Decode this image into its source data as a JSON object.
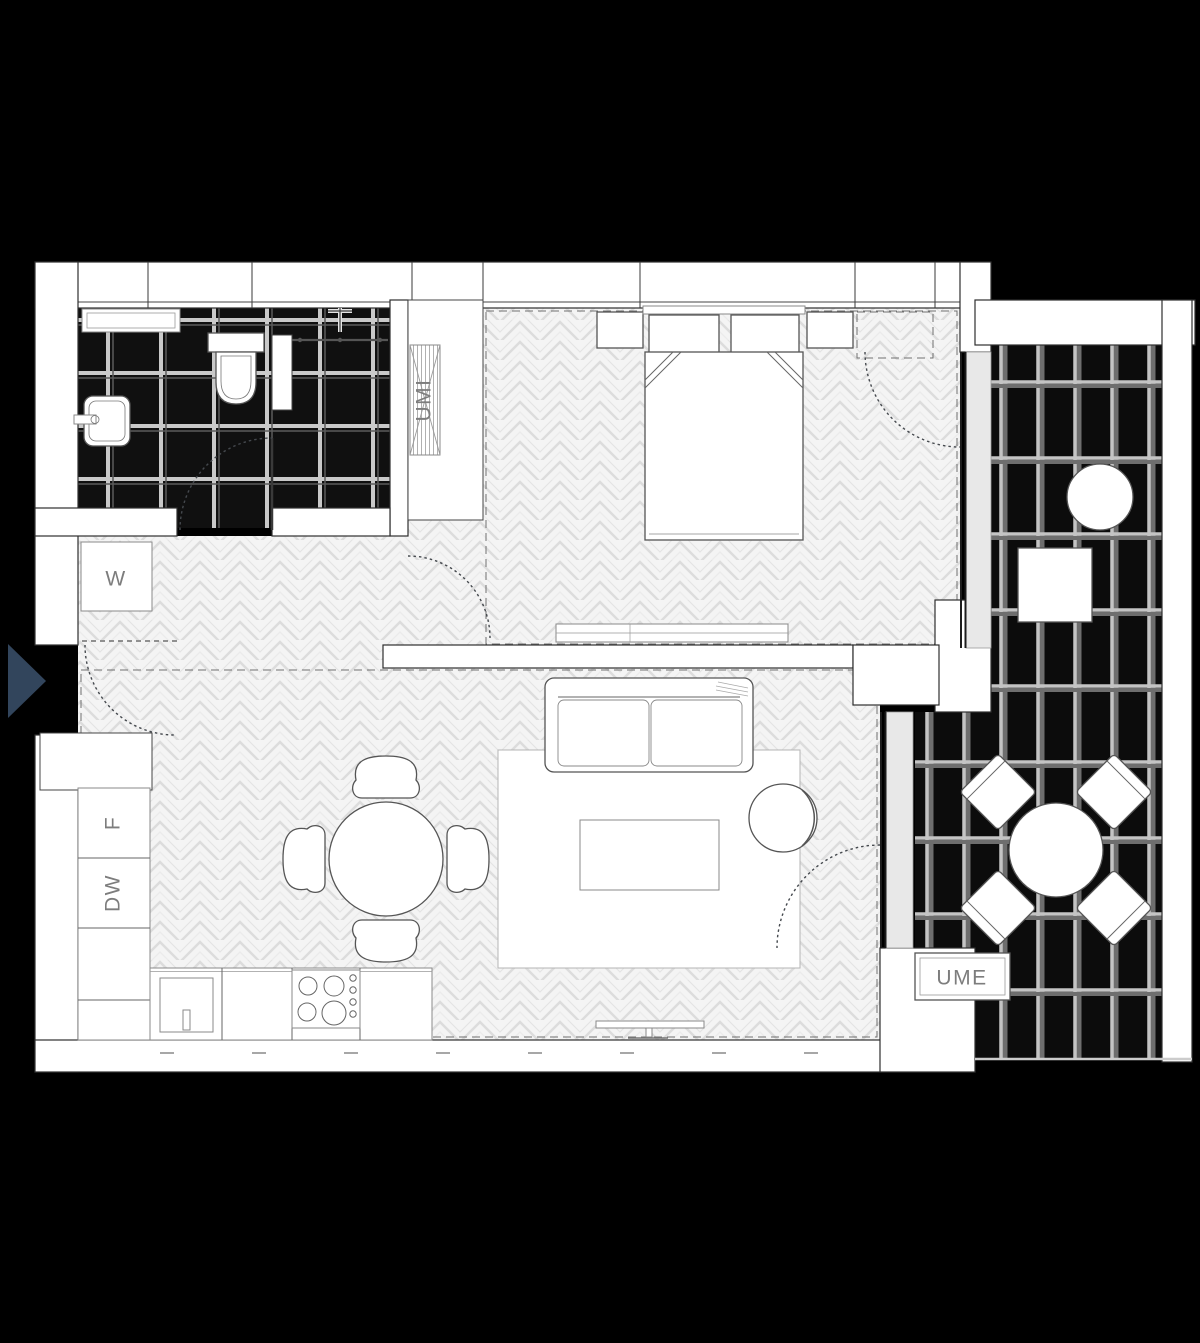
{
  "title": "apartment-floor-plan",
  "plan": {
    "labels": {
      "washer": "W",
      "fridge": "F",
      "dishwasher": "DW",
      "wardrobe_unit": "UMI",
      "outdoor_unit": "UME"
    },
    "colors": {
      "background": "#000000",
      "wall": "#ffffff",
      "outline": "#2e2e2e",
      "floor_wood": "#f4f4f4",
      "floor_tile_dark": "#101010",
      "grout": "#c9c9c9",
      "label_text": "#7d7d7d",
      "entry_arrow": "#32455c"
    }
  }
}
